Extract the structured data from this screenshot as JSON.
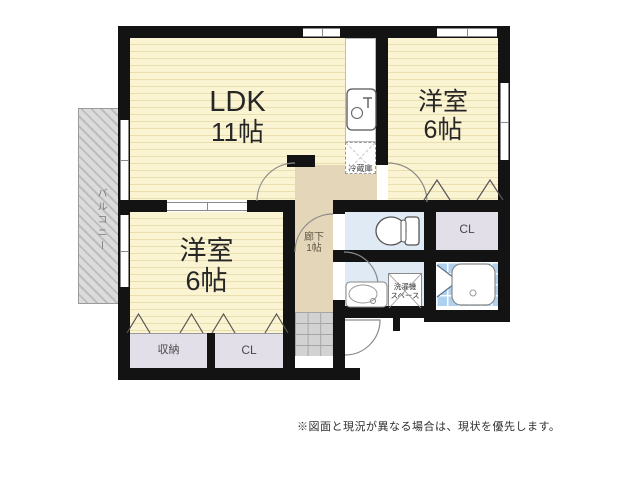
{
  "floorplan": {
    "ldk": {
      "name": "LDK",
      "size": "11帖"
    },
    "bedroom_top_right": {
      "name": "洋室",
      "size": "6帖"
    },
    "bedroom_bottom_left": {
      "name": "洋室",
      "size": "6帖"
    },
    "hallway": {
      "name": "廊下",
      "size": "1帖"
    },
    "balcony_label": "バルコニー",
    "closet_top_right": "CL",
    "closet_bottom": "CL",
    "storage_label": "収納",
    "fridge_label": "冷蔵庫",
    "washer_line1": "洗濯機",
    "washer_line2": "スペース",
    "disclaimer": "※図面と現況が異なる場合は、現状を優先します。"
  },
  "colors": {
    "wall": "#131313",
    "room_yellow": "#fbf4d2",
    "hallway_beige": "#e4d6b8",
    "water_blue": "#dfeaf5",
    "bath_tile_blue": "#aed1ef",
    "closet_gray": "#e3dfe9",
    "balcony_gray": "#dbdbdb"
  }
}
